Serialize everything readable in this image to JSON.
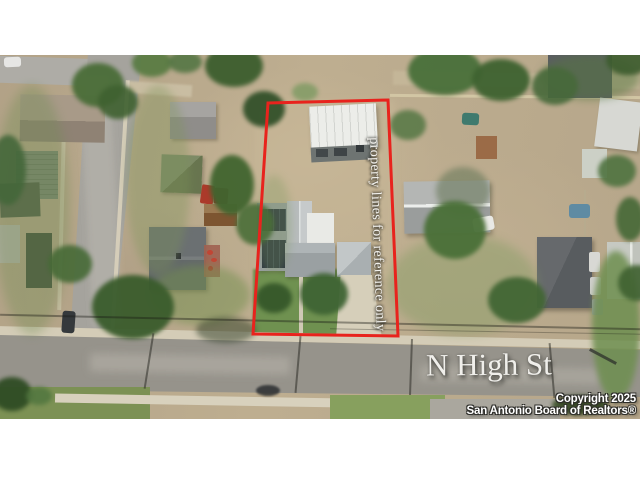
{
  "meta": {
    "kind": "aerial real-estate listing photo",
    "letterbox": "white"
  },
  "overlays": {
    "property_note": "property lines for reference only",
    "street_name": "N High St",
    "copyright_line1": "Copyright 2025",
    "copyright_line2": "San Antonio Board of Realtors®"
  },
  "colors": {
    "boundary_red": "#e8231d",
    "text_white": "#f0efeb"
  }
}
